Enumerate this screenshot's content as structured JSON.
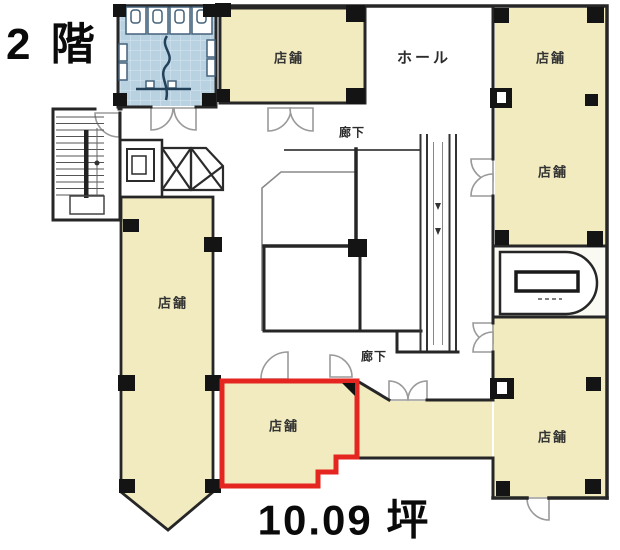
{
  "plan": {
    "floor_label": "2 階",
    "area_label": "10.09 坪",
    "hall_label": "ホール",
    "corridor_upper_label": "廊下",
    "corridor_lower_label": "廊下",
    "rooms": [
      {
        "id": "shop-top-center",
        "label": "店舗"
      },
      {
        "id": "shop-right-upper",
        "label": "店舗"
      },
      {
        "id": "shop-right-lower",
        "label": "店舗"
      },
      {
        "id": "shop-left",
        "label": "店舗"
      },
      {
        "id": "shop-highlighted",
        "label": "店舗",
        "highlighted": "true",
        "area": "10.09 坪"
      },
      {
        "id": "shop-bottom-right",
        "label": "店舗"
      }
    ],
    "colors": {
      "shop_fill": "#f1ebbf",
      "corridor_fill": "#f1ebbf",
      "restroom_fill": "#b9d2e2",
      "restroom_tile_line": "#d6e6f0",
      "oval_room_fill": "#fbfaf2",
      "wall": "#262626",
      "door_arc": "#9a9a9a",
      "highlight_red": "#e52520",
      "text": "#1a1a1a"
    }
  }
}
